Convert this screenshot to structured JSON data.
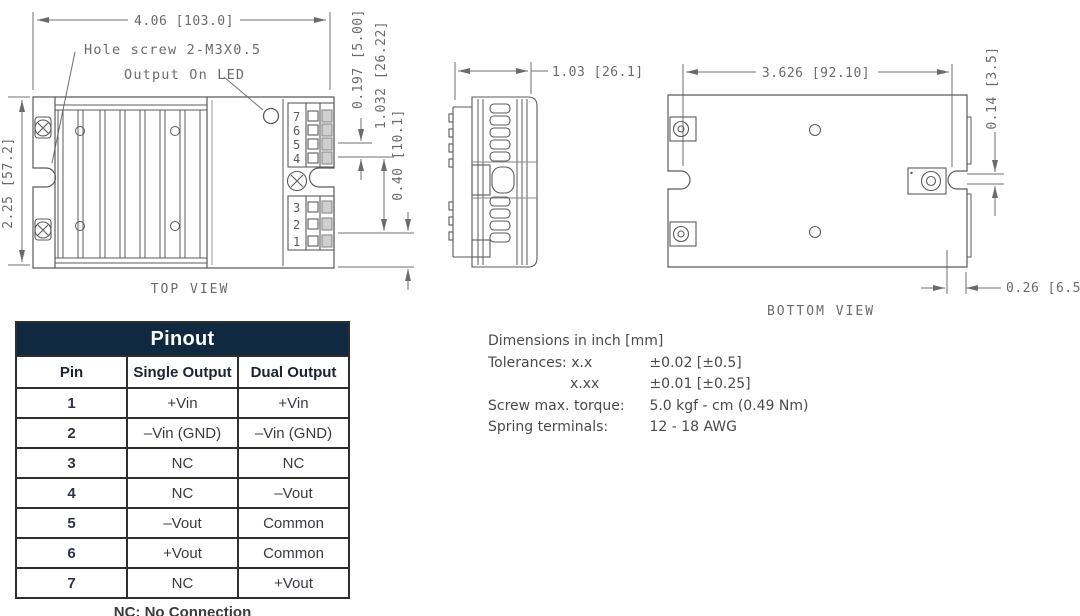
{
  "colors": {
    "table_header_bg": "#0f2940",
    "table_header_text": "#ffffff",
    "table_border": "#2e2e2e",
    "drawing_stroke": "#5b5b5b",
    "drawing_text": "#6b6b6b"
  },
  "top_view": {
    "caption": "TOP VIEW",
    "dim_width": "4.06 [103.0]",
    "dim_height": "2.25 [57.2]",
    "dim_pin_pitch": "0.197 [5.00]",
    "dim_terminal_span": "1.032 [26.22]",
    "dim_bottom_offset": "0.40 [10.1]",
    "label_hole_screw": "Hole screw 2-M3X0.5",
    "label_led": "Output On LED",
    "pins_top": [
      "7",
      "6",
      "5",
      "4"
    ],
    "pins_bottom": [
      "3",
      "2",
      "1"
    ]
  },
  "side_view": {
    "dim_width": "1.03 [26.1]"
  },
  "bottom_view": {
    "caption": "BOTTOM VIEW",
    "dim_width": "3.626 [92.10]",
    "dim_notch": "0.14 [3.5]",
    "dim_edge": "0.26 [6.5]"
  },
  "pinout": {
    "title": "Pinout",
    "columns": [
      "Pin",
      "Single Output",
      "Dual Output"
    ],
    "rows": [
      {
        "pin": "1",
        "single": "+Vin",
        "dual": "+Vin"
      },
      {
        "pin": "2",
        "single": "–Vin (GND)",
        "dual": "–Vin (GND)"
      },
      {
        "pin": "3",
        "single": "NC",
        "dual": "NC"
      },
      {
        "pin": "4",
        "single": "NC",
        "dual": "–Vout"
      },
      {
        "pin": "5",
        "single": "–Vout",
        "dual": "Common"
      },
      {
        "pin": "6",
        "single": "+Vout",
        "dual": "Common"
      },
      {
        "pin": "7",
        "single": "NC",
        "dual": "+Vout"
      }
    ],
    "footnote": "NC: No Connection"
  },
  "notes": {
    "units": "Dimensions in inch [mm]",
    "tol_label": "Tolerances: x.x",
    "tol_value": "±0.02 [±0.5]",
    "tol2_label": "x.xx",
    "tol2_value": "±0.01 [±0.25]",
    "torque_label": "Screw max. torque:",
    "torque_value": "5.0 kgf - cm (0.49 Nm)",
    "spring_label": "Spring terminals:",
    "spring_value": "12 - 18 AWG"
  }
}
